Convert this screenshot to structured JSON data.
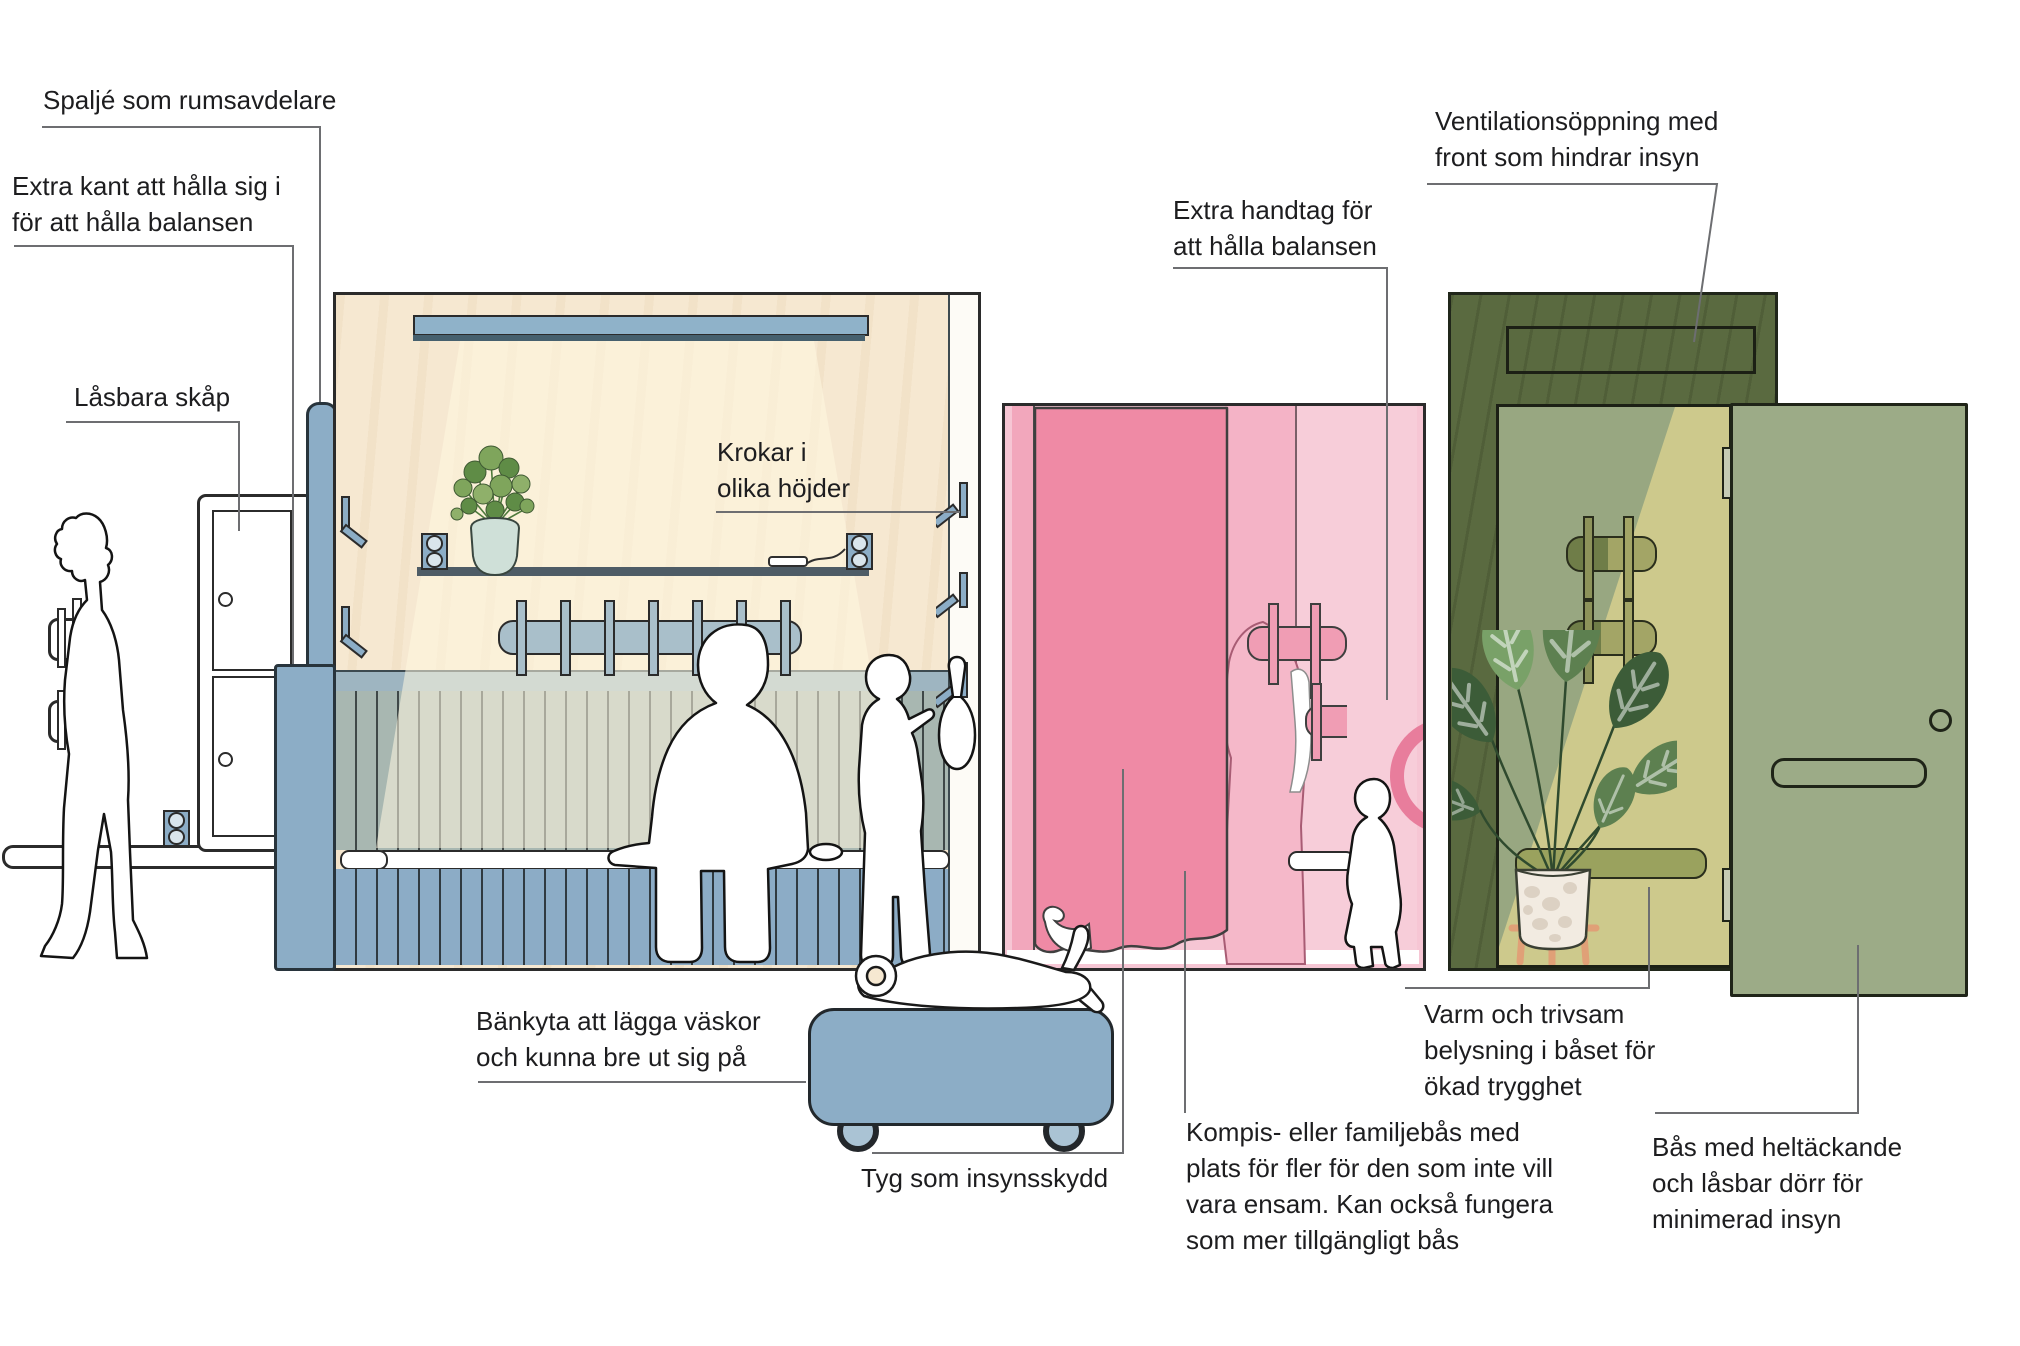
{
  "figure_type": "annotated-infographic",
  "language": "sv",
  "annotations": {
    "spalje": {
      "text": "Spaljé som rumsavdelare"
    },
    "extra_kant": {
      "lines": [
        "Extra kant att hålla sig i",
        "för att hålla balansen"
      ]
    },
    "lasbara_skap": {
      "text": "Låsbara skåp"
    },
    "krokar": {
      "lines": [
        "Krokar i",
        "olika höjder"
      ]
    },
    "ventilation": {
      "lines": [
        "Ventilationsöppning med",
        "front som hindrar insyn"
      ]
    },
    "extra_handtag": {
      "lines": [
        "Extra handtag för",
        "att hålla balansen"
      ]
    },
    "bankyta": {
      "lines": [
        "Bänkyta att lägga väskor",
        "och kunna bre ut sig på"
      ]
    },
    "tyg": {
      "text": "Tyg som insynsskydd"
    },
    "kompis": {
      "lines": [
        "Kompis- eller familjebås med",
        "plats för fler för den som inte vill",
        "vara ensam. Kan också fungera",
        "som mer tillgängligt bås"
      ]
    },
    "varm": {
      "lines": [
        "Varm och trivsam",
        "belysning i båset för",
        "ökad trygghet"
      ]
    },
    "bas_dorr": {
      "lines": [
        "Bås med heltäckande",
        "och låsbar dörr för",
        "minimerad insyn"
      ]
    }
  },
  "colors": {
    "text": "#1d1d1f",
    "leader": "#6d6e71",
    "outline": "#2b2b2b",
    "steel-blue": "#8cadc6",
    "light-bar-blue": "#8fb2c9",
    "light-bar-shadow": "#46606e",
    "wood": "#f6e8d1",
    "beam": "#fdf4de",
    "shelf-dark": "#4e5c66",
    "band-blue": "#9eb5c1",
    "slat-green": "#a8b7b1",
    "slat-blue": "#8cacc6",
    "rail-blue": "#a9bfca",
    "pink-bg": "#f6c6d4",
    "pink-strip": "#f2a7bc",
    "pink-mid": "#f4b3c6",
    "pink-light": "#f7cdd9",
    "pink-curtain": "#ef8aa5",
    "pink-rail": "#f09db4",
    "pink-handle": "#e87d9c",
    "green-dark": "#5a6a40",
    "green-sage": "#98a781",
    "green-beam": "#cdc98c",
    "green-rail-dark": "#6f7d48",
    "green-rail-light": "#a3a566",
    "green-bench": "#9aa25e",
    "door-green": "#9cab87",
    "hinge": "#c5cbb4",
    "pot-white": "#f2ebe1",
    "stand-orange": "#e0a077",
    "leaf-dark": "#3c5c38",
    "leaf-mid": "#5d8050",
    "leaf-light": "#79a168",
    "pilea-pot": "#cfe0d8"
  }
}
